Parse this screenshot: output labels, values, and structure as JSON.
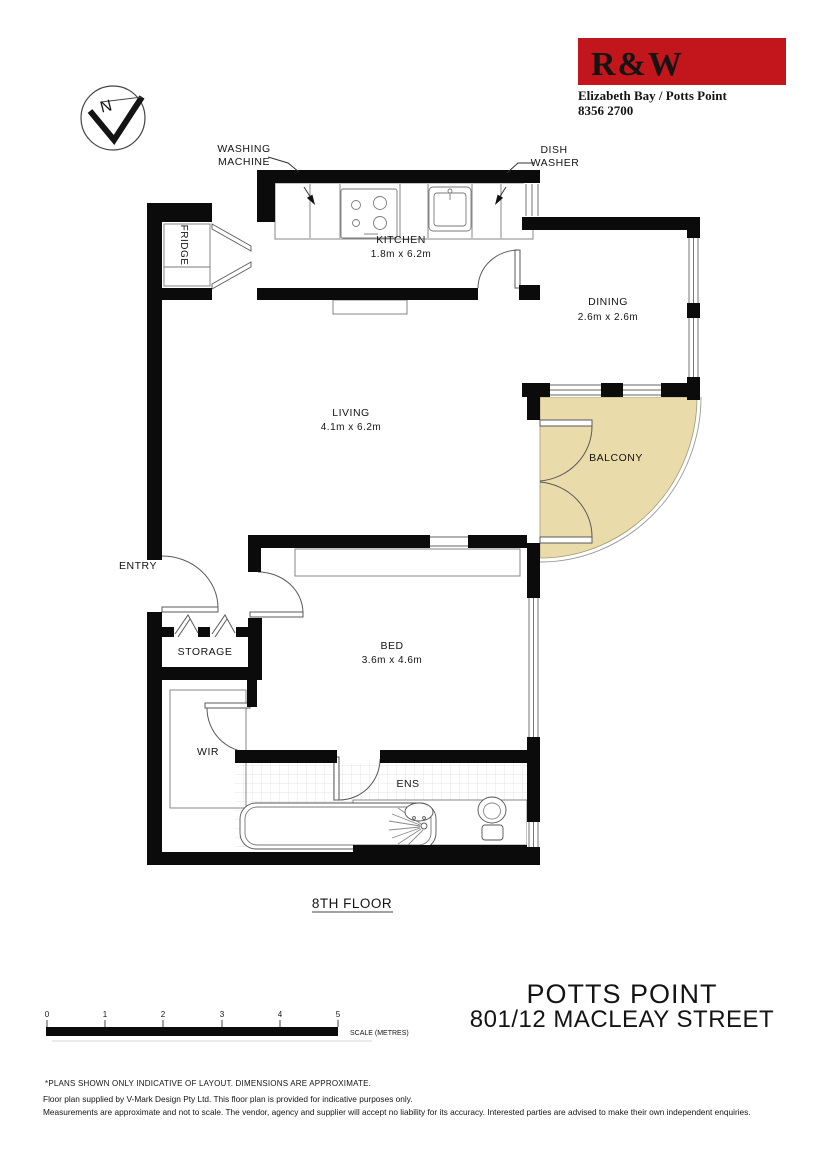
{
  "branding": {
    "logo": "R&W",
    "office": "Elizabeth Bay / Potts Point",
    "phone": "8356 2700",
    "brand_color": "#c3161c"
  },
  "compass": {
    "north": "N"
  },
  "plan": {
    "rooms": {
      "kitchen": {
        "name": "KITCHEN",
        "dims": "1.8m x 6.2m"
      },
      "dining": {
        "name": "DINING",
        "dims": "2.6m x 2.6m"
      },
      "living": {
        "name": "LIVING",
        "dims": "4.1m x 6.2m"
      },
      "balcony": {
        "name": "BALCONY"
      },
      "bed": {
        "name": "BED",
        "dims": "3.6m x 4.6m"
      },
      "ens": {
        "name": "ENS"
      },
      "wir": {
        "name": "WIR"
      },
      "storage": {
        "name": "STORAGE"
      },
      "entry": {
        "name": "ENTRY"
      },
      "fridge": {
        "name": "FRIDGE"
      }
    },
    "callouts": {
      "washing1": "WASHING",
      "washing2": "MACHINE",
      "dish1": "DISH",
      "dish2": "WASHER"
    },
    "floor": "8TH FLOOR",
    "balcony_color": "#eadbaa"
  },
  "scalebar": {
    "t0": "0",
    "t1": "1",
    "t2": "2",
    "t3": "3",
    "t4": "4",
    "t5": "5",
    "label": "SCALE (METRES)"
  },
  "address": {
    "suburb": "POTTS POINT",
    "street": "801/12 MACLEAY STREET"
  },
  "disclaimer": {
    "line1": "*PLANS SHOWN ONLY INDICATIVE OF LAYOUT. DIMENSIONS ARE APPROXIMATE.",
    "line2": "Floor plan supplied by V-Mark Design Pty Ltd. This floor plan is provided for indicative purposes only.",
    "line3": "Measurements are approximate and not to scale. The vendor, agency and supplier will accept no liability for its accuracy. Interested parties are advised to make their own independent enquiries."
  }
}
